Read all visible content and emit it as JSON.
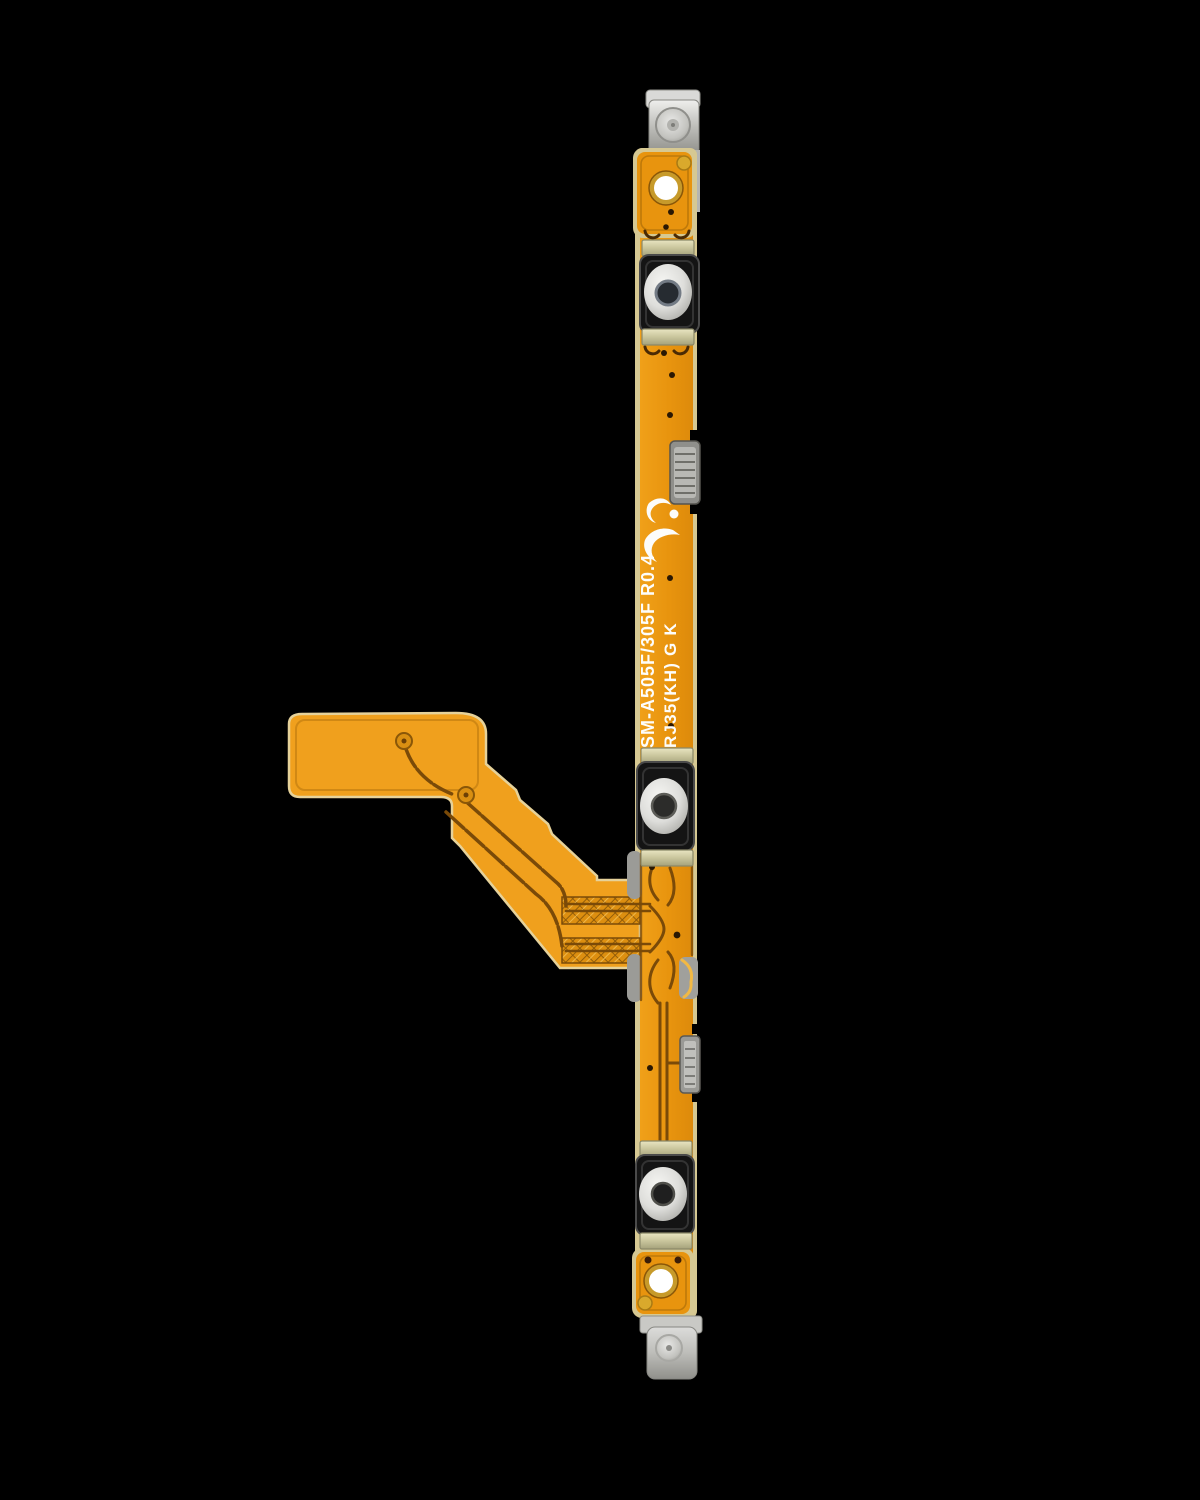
{
  "photo": {
    "subject": "power-volume-button-flex-cable",
    "background_color": "#000000"
  },
  "markings": {
    "line1": "SM-A505F/305F R0.4",
    "line2": "RJ35(KH) G K"
  },
  "components": {
    "top_bracket": "metal-mounting-bracket-top",
    "bottom_bracket": "metal-mounting-bracket-bottom",
    "switch_top": "tactile-switch-top",
    "switch_middle": "tactile-switch-middle",
    "switch_bottom": "tactile-switch-bottom",
    "side_contact_upper": "spring-contact-upper",
    "side_contact_lower": "spring-contact-lower",
    "connector_tail": "flex-connector-tail",
    "logo": "manufacturer-logo"
  },
  "colors": {
    "flex_amber": "#E8940E",
    "flex_branch_orange": "#F0A01D",
    "pale_pcb_edge": "#D6C892",
    "trace_brown": "#7A4A08",
    "hatch_copper": "#DD8F10",
    "metal_grey": "#C2C2BE",
    "solder_clip_khaki": "#C9C59C",
    "switch_housing_black": "#161616",
    "switch_dome_silver": "#E9E9E6",
    "gold_pad": "#D9A92C",
    "silkscreen_white": "#FDFDFB",
    "background": "#000000"
  }
}
